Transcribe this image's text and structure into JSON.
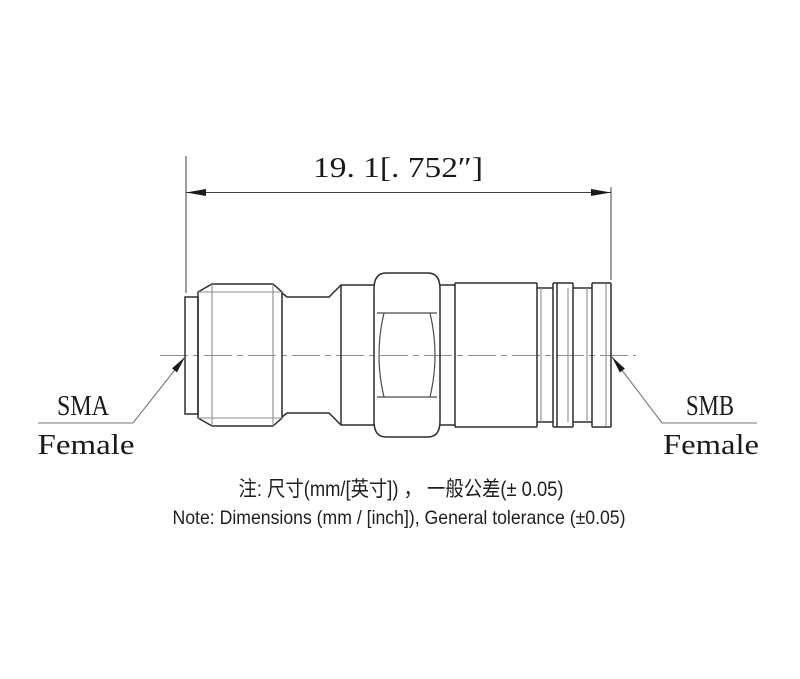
{
  "page": {
    "background": "#ffffff"
  },
  "dimension": {
    "label": "19. 1[. 752″]"
  },
  "connectors": {
    "left": {
      "type": "SMA",
      "gender": "Female"
    },
    "right": {
      "type": "SMB",
      "gender": "Female"
    }
  },
  "notes": {
    "chinese": "注: 尺寸(mm/[英寸]) ， 一般公差(± 0.05)",
    "english": "Note: Dimensions (mm / [inch]), General tolerance (±0.05)"
  },
  "colors": {
    "outline": "#2d2d2d",
    "light_line": "#8e8e8e",
    "text": "#1a1a1a",
    "background": "#ffffff"
  }
}
